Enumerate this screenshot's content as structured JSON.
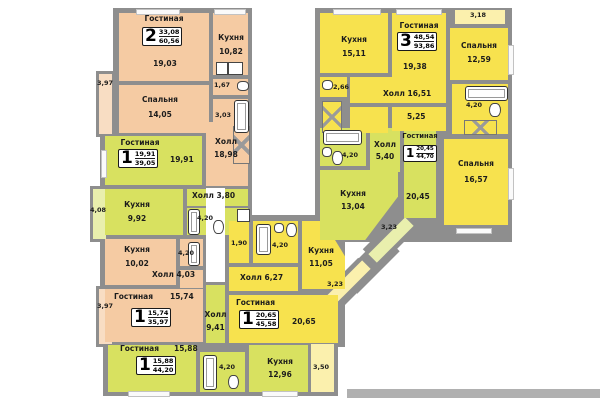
{
  "apartments": {
    "a6056": {
      "rooms": "2",
      "living_total": "33,08",
      "total": "60,56",
      "living": "Гостиная",
      "living_a": "19,03",
      "kitchen": "Кухня",
      "kitchen_a": "10,82",
      "bedroom": "Спальня",
      "bedroom_a": "14,05",
      "wc_a": "1,67",
      "bath_a": "3,03",
      "balcony_a": "3,97",
      "hall": "Холл",
      "hall_a": "18,98"
    },
    "a9386": {
      "rooms": "3",
      "living_total": "48,54",
      "total": "93,86",
      "kitchen": "Кухня",
      "kitchen_a": "15,11",
      "living": "Гостиная",
      "living_a": "19,38",
      "bedroom1": "Спальня",
      "bedroom1_a": "12,59",
      "bedroom2": "Спальня",
      "bedroom2_a": "16,57",
      "balcony_a": "3,18",
      "wc_a": "2,66",
      "hall": "Холл",
      "hall_a": "16,51",
      "storage_a": "5,25",
      "bath_a": "4,20"
    },
    "a3905": {
      "rooms": "1",
      "living_total": "19,91",
      "total": "39,05",
      "living": "Гостиная",
      "living_a": "19,91",
      "kitchen": "Кухня",
      "kitchen_a": "9,92",
      "hall": "Холл",
      "hall_a": "3,80",
      "bath_a": "4,20",
      "balcony_a": "4,08"
    },
    "a3597": {
      "rooms": "1",
      "living_total": "15,74",
      "total": "35,97",
      "living": "Гостиная",
      "living_a": "15,74",
      "kitchen": "Кухня",
      "kitchen_a": "10,02",
      "hall": "Холл",
      "hall_a": "4,03",
      "bath_a": "4,20",
      "balcony_a": "3,97"
    },
    "a4420": {
      "rooms": "1",
      "living_total": "15,88",
      "total": "44,20",
      "living": "Гостиная",
      "living_a": "15,88",
      "kitchen": "Кухня",
      "kitchen_a": "12,96",
      "hall": "Холл",
      "hall_a": "9,41",
      "bath_a": "4,20",
      "balcony_a": "3,50"
    },
    "a4558": {
      "rooms": "1",
      "living_total": "20,65",
      "total": "45,58",
      "living": "Гостиная",
      "living_a": "20,65",
      "kitchen": "Кухня",
      "kitchen_a": "11,05",
      "hall": "Холл",
      "hall_a": "6,27",
      "wc_a": "1,90",
      "bath_a": "4,20",
      "balcony_a": "3,23"
    },
    "a4470": {
      "rooms": "1",
      "living_total": "20,45",
      "total": "44,70",
      "living": "Гостиная",
      "living_a": "20,45",
      "kitchen": "Кухня",
      "kitchen_a": "13,04",
      "hall": "Холл",
      "hall_a": "5,40",
      "bath_a": "4,20",
      "balcony_a": "3,23"
    }
  },
  "palette": {
    "wall": "#8e8e8e",
    "peach": "#f5cba3",
    "green": "#d8e160",
    "yellow": "#f7e24e"
  }
}
